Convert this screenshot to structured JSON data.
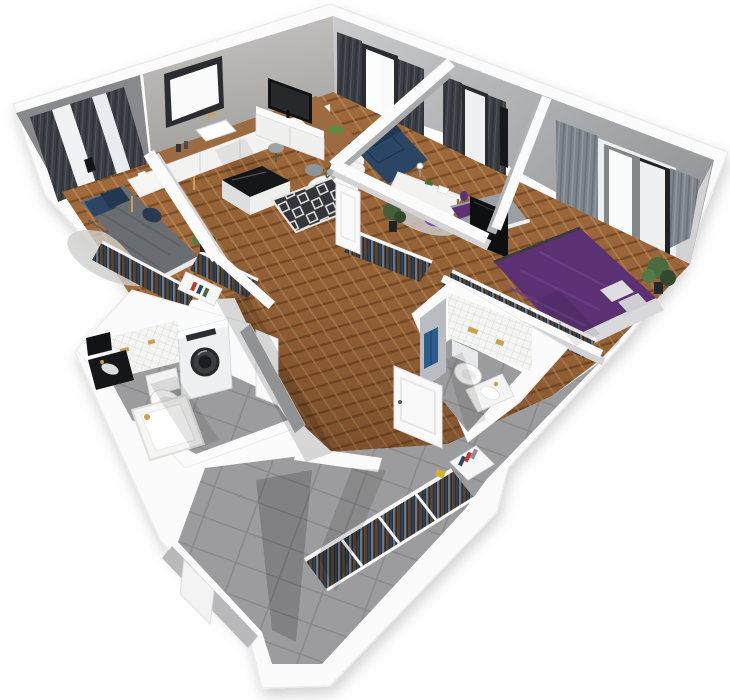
{
  "meta": {
    "type": "3d-floor-plan-render",
    "width": 730,
    "height": 700,
    "background": "#ffffff"
  },
  "palette": {
    "bg": "#ffffff",
    "wallTop": "#fbfbfb",
    "wallEdge": "#ececec",
    "wallShadow": "#d3d3d5",
    "faceLight": "#cdcdcf",
    "faceMid": "#a7a7a9",
    "faceDark": "#87898d",
    "faceWarm": "#b6b4b0",
    "woodLight": "#b5824f",
    "wood": "#a06a3c",
    "woodDark": "#7e4f28",
    "tileGray": "#9c9c9e",
    "tileGrout": "#8a8a8c",
    "tileWhite": "#f4f4f2",
    "curtainDark": "#3b3f45",
    "curtainDarker": "#2e3237",
    "curtainGray": "#7e848c",
    "sheer": "#ffffff",
    "glass": "#fafafa",
    "frameDark": "#2a2c2f",
    "navy": "#2b4664",
    "navyDark": "#223852",
    "purple": "#5b3174",
    "purpleLight": "#7a4fae",
    "gold": "#c9a14e",
    "green": "#4a6b3f",
    "greenDark": "#32492e",
    "dark": "#141619",
    "grayFurniture": "#9ea3a7",
    "white": "#ffffff",
    "offWhite": "#f2f2f0",
    "blanketGray": "#6a6d71",
    "towelBlue": "#2d5b8c",
    "bookRed": "#c0392b",
    "bookYellow": "#d4b12e"
  },
  "scene": {
    "rooms": [
      {
        "id": "bedroom-1",
        "name": "Bedroom 1",
        "furniture": [
          "double-bed-gray-blanket",
          "blue-pillows",
          "desk-with-sewing-machine",
          "office-chair",
          "open-wardrobe-clothes",
          "bookshelf",
          "window-with-dark-curtains",
          "potted-plant",
          "rug"
        ]
      },
      {
        "id": "kitchen-living-room",
        "name": "Kitchen / Living room",
        "furniture": [
          "l-shaped-kitchen-counter",
          "kitchen-sink-gold-faucet",
          "kitchen-island-black-top",
          "bar-stools",
          "kitchen-window",
          "tv",
          "tv-sideboard",
          "navy-sofa",
          "round-coffee-table",
          "dining-chairs",
          "diamond-pattern-rug",
          "balcony-windows-with-curtains"
        ]
      },
      {
        "id": "kids-room",
        "name": "Kids room / Study",
        "furniture": [
          "white-desk",
          "desk-lamp",
          "toy-dinosaur",
          "purple-chair",
          "purple-floor-lamp",
          "single-bed",
          "wall-tv-panel",
          "potted-plant",
          "gray-rug",
          "open-wardrobe-clothes",
          "window-with-curtains"
        ]
      },
      {
        "id": "master-bedroom",
        "name": "Master bedroom",
        "furniture": [
          "double-bed-purple-duvet",
          "open-wardrobe-rail-clothes",
          "large-window-with-gray-curtains",
          "potted-plant",
          "black-floor-mat"
        ]
      },
      {
        "id": "bathroom-1",
        "name": "Bathroom with laundry",
        "furniture": [
          "washing-machine",
          "toilet",
          "bathtub-gold-faucet",
          "black-vanity-sink",
          "white-tile-wall",
          "door"
        ]
      },
      {
        "id": "bathroom-2",
        "name": "Bathroom 2",
        "furniture": [
          "wall-hung-toilet",
          "washbasin",
          "blue-towel",
          "mosaic-tile-wall",
          "black-mat",
          "door"
        ]
      },
      {
        "id": "hallway",
        "name": "Hallway",
        "furniture": [
          "herringbone-wood-floor",
          "doors"
        ]
      },
      {
        "id": "entry-hall",
        "name": "Entry hall",
        "furniture": [
          "long-open-wardrobe-clothes",
          "shelf-unit-with-books",
          "gray-tile-floor",
          "entrance-door"
        ]
      }
    ]
  }
}
